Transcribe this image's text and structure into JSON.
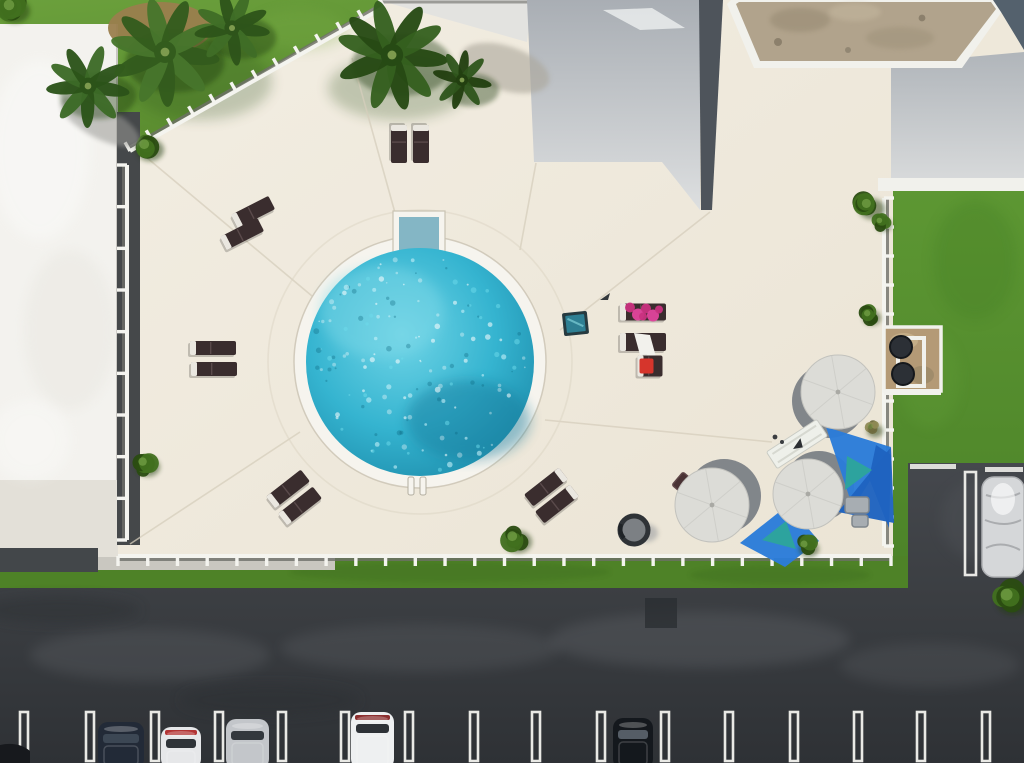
{
  "scene": {
    "kind": "aerial-photo",
    "subject": "overhead drone view of a condominium pool deck with circular pool, loungers, umbrellas, blue shade sails, lawns and parking lot",
    "palette": {
      "deck": "#efe8d9",
      "deck_light": "#f7f2e8",
      "joint": "#d6cebc",
      "grass": "#679a3a",
      "grass_dark": "#3f6b1d",
      "grass_right": "#55912e",
      "grass_strip": "#4e8227",
      "roof_white": "#f3f2ee",
      "roof_edge": "#c9c7c2",
      "roof_gray_top": "#a9aeb4",
      "roof_gray_bottom": "#dddfe0",
      "roof_dark": "#4e545b",
      "roof_tan": "#b1a38c",
      "roof_tan_dark": "#93866e",
      "roof_slate": "#54616d",
      "trim": "#f1f1ec",
      "asphalt": "#3d4145",
      "asphalt_light": "#73777c",
      "asphalt_dark": "#2b2e32",
      "line": "#e9e9e5",
      "water": "#2fb3cf",
      "water_light": "#8fe0ee",
      "water_dark": "#167f9f",
      "water_step": "#84b6c5",
      "coping": "#f6f4ee",
      "fence": "#f4f4ef",
      "fence_shadow": "#6f7069",
      "walk": "#e3e0d8",
      "walk_dark": "#43474a",
      "lounger": "#3a2d2e",
      "lounger_head": "#eae7e0",
      "umbrella": "#dcdcd7",
      "umbrella_shadow": "#6e747c",
      "sail": "#2b7cd9",
      "sail_deep": "#1f63c0",
      "sail_teal": "#2da49c",
      "towel_pink": "#e0459c",
      "towel_pink2": "#c9327f",
      "towel_red": "#d6352c",
      "bush": "#41701f",
      "bush_dark": "#2a4c11",
      "bush_dry": "#8f8a55",
      "palm_brown": "#9a7e4d",
      "grill_base": "#b49a76",
      "grill_dark": "#2c3036",
      "bench": "#eef0ea",
      "glass": "#333a42",
      "tarp": "#d5d7d9",
      "teal_table": "#2e7f93",
      "teal_table_edge": "#263a40"
    },
    "pool": {
      "cx": 420,
      "cy": 362,
      "water_r": 114,
      "ring_r": 126,
      "steps": {
        "x": 397,
        "y": 215,
        "w": 44,
        "h": 42
      },
      "ladder": [
        {
          "x": 408,
          "y": 477,
          "w": 6,
          "h": 18
        },
        {
          "x": 420,
          "y": 477,
          "w": 6,
          "h": 18
        }
      ]
    },
    "loungers": [
      {
        "cx": 399,
        "cy": 144,
        "len": 38,
        "wid": 16,
        "rot": 90
      },
      {
        "cx": 421,
        "cy": 144,
        "len": 38,
        "wid": 16,
        "rot": 90
      },
      {
        "cx": 253,
        "cy": 212,
        "len": 42,
        "wid": 15,
        "rot": -27
      },
      {
        "cx": 242,
        "cy": 234,
        "len": 42,
        "wid": 15,
        "rot": -27
      },
      {
        "cx": 213,
        "cy": 348,
        "len": 46,
        "wid": 14,
        "rot": 0
      },
      {
        "cx": 214,
        "cy": 369,
        "len": 46,
        "wid": 14,
        "rot": 0
      },
      {
        "cx": 288,
        "cy": 489,
        "len": 44,
        "wid": 15,
        "rot": -38
      },
      {
        "cx": 300,
        "cy": 506,
        "len": 44,
        "wid": 15,
        "rot": -38
      },
      {
        "cx": 546,
        "cy": 487,
        "len": 44,
        "wid": 15,
        "rot": -38,
        "head": "+x"
      },
      {
        "cx": 557,
        "cy": 504,
        "len": 44,
        "wid": 15,
        "rot": -38,
        "head": "+x"
      },
      {
        "cx": 643,
        "cy": 312,
        "len": 46,
        "wid": 17,
        "rot": 0,
        "towel": "pink"
      },
      {
        "cx": 643,
        "cy": 342,
        "len": 46,
        "wid": 18,
        "rot": 0,
        "towel": "white"
      },
      {
        "cx": 650,
        "cy": 366,
        "len": 25,
        "wid": 21,
        "rot": 0,
        "towel": "red"
      }
    ],
    "side_table": {
      "x": 563,
      "y": 312,
      "w": 25,
      "h": 23
    },
    "small_item": {
      "x": 600,
      "y": 293,
      "w": 10,
      "h": 7
    },
    "umbrellas": [
      {
        "cx": 838,
        "cy": 392,
        "r": 37,
        "sdx": -9,
        "sdy": 9
      },
      {
        "cx": 712,
        "cy": 505,
        "r": 37,
        "sdx": 12,
        "sdy": -9
      },
      {
        "cx": 808,
        "cy": 494,
        "r": 35,
        "sdx": 11,
        "sdy": -8
      }
    ],
    "sails": [
      {
        "points": "826,427 891,447 853,508",
        "tone": "sail"
      },
      {
        "points": "891,447 894,523 838,512",
        "tone": "sail_deep"
      },
      {
        "points": "740,543 788,505 819,541 785,567",
        "tone": "sail"
      },
      {
        "points": "876,445 891,455 889,528 869,478",
        "tone": "sail_deep"
      },
      {
        "points": "847,456 872,470 845,490",
        "tone": "sail_teal"
      },
      {
        "points": "762,540 786,521 796,549",
        "tone": "sail_teal"
      }
    ],
    "bench": {
      "cx": 797,
      "cy": 444,
      "len": 60,
      "wid": 20,
      "rot": -33
    },
    "firepit": {
      "cx": 634,
      "cy": 530,
      "r": 14
    },
    "diamond_table": {
      "cx": 684,
      "cy": 484,
      "s": 17
    },
    "grill": {
      "x": 884,
      "y": 327,
      "w": 57,
      "h": 64
    },
    "equipment": [
      {
        "x": 845,
        "y": 497,
        "w": 24,
        "h": 16
      },
      {
        "x": 852,
        "y": 515,
        "w": 16,
        "h": 12
      }
    ],
    "fences": [
      {
        "x1": 384,
        "y1": 7,
        "x2": 130,
        "y2": 151,
        "posts": 12,
        "side": 1
      },
      {
        "x1": 118,
        "y1": 556,
        "x2": 891,
        "y2": 556,
        "posts": 26,
        "side": 1
      },
      {
        "x1": 884,
        "y1": 198,
        "x2": 884,
        "y2": 546,
        "posts": 12,
        "side": -1
      },
      {
        "x1": 127,
        "y1": 165,
        "x2": 127,
        "y2": 540,
        "posts": 9,
        "side": 1
      }
    ],
    "bushes": [
      {
        "cx": 147,
        "cy": 147,
        "r": 14
      },
      {
        "cx": 145,
        "cy": 464,
        "r": 12
      },
      {
        "cx": 515,
        "cy": 539,
        "r": 14
      },
      {
        "cx": 806,
        "cy": 546,
        "r": 10
      },
      {
        "cx": 869,
        "cy": 206,
        "r": 13
      },
      {
        "cx": 881,
        "cy": 222,
        "r": 8
      },
      {
        "cx": 869,
        "cy": 315,
        "r": 9
      },
      {
        "cx": 872,
        "cy": 428,
        "r": 8,
        "dry": true
      },
      {
        "cx": 1010,
        "cy": 598,
        "r": 17
      },
      {
        "cx": 12,
        "cy": 8,
        "r": 15
      }
    ],
    "palms": [
      {
        "cx": 88,
        "cy": 86,
        "r": 42,
        "n": 9,
        "c1": "#3c6a26",
        "c2": "#2c5319"
      },
      {
        "cx": 165,
        "cy": 52,
        "r": 55,
        "n": 10,
        "c1": "#47762c",
        "c2": "#335c1d"
      },
      {
        "cx": 232,
        "cy": 28,
        "r": 38,
        "n": 9,
        "c1": "#3f6d26",
        "c2": "#2e541a"
      },
      {
        "cx": 392,
        "cy": 55,
        "r": 56,
        "n": 10,
        "c1": "#35601f",
        "c2": "#264a14"
      },
      {
        "cx": 462,
        "cy": 80,
        "r": 30,
        "n": 8,
        "c1": "#2f551c",
        "c2": "#223f10"
      }
    ],
    "parking": {
      "stall_line_xs": [
        20,
        86,
        151,
        215,
        278,
        341,
        405,
        470,
        532,
        597,
        661,
        725,
        790,
        854,
        917,
        982
      ],
      "stall_line_y": 712,
      "stall_line_h": 49,
      "right_stall_lines": [
        {
          "x": 910,
          "y": 464,
          "w": 46,
          "h": 5
        },
        {
          "x": 985,
          "y": 467,
          "w": 38,
          "h": 5
        }
      ],
      "right_divider": {
        "x": 965,
        "y": 472,
        "w": 11,
        "h": 103
      },
      "dark_patch": {
        "x": 645,
        "y": 598,
        "w": 32,
        "h": 30
      },
      "cars": [
        {
          "x": 98,
          "y": 722,
          "w": 46,
          "h": 41,
          "body": "#222a37",
          "glass": "#3c4754",
          "accent": ""
        },
        {
          "x": 161,
          "y": 727,
          "w": 40,
          "h": 36,
          "body": "#e6e7e9",
          "glass": "#2f3338",
          "accent": "#b23434"
        },
        {
          "x": 226,
          "y": 719,
          "w": 43,
          "h": 44,
          "body": "#c3c6ca",
          "glass": "#33383d",
          "accent": ""
        },
        {
          "x": 351,
          "y": 712,
          "w": 43,
          "h": 51,
          "body": "#eef0f1",
          "glass": "#2e3237",
          "accent": "#8c2f2f"
        },
        {
          "x": 613,
          "y": 718,
          "w": 40,
          "h": 45,
          "body": "#14181d",
          "glass": "#555d66",
          "accent": ""
        }
      ],
      "tarp_car": {
        "x": 982,
        "y": 477,
        "w": 42,
        "h": 100
      }
    }
  }
}
